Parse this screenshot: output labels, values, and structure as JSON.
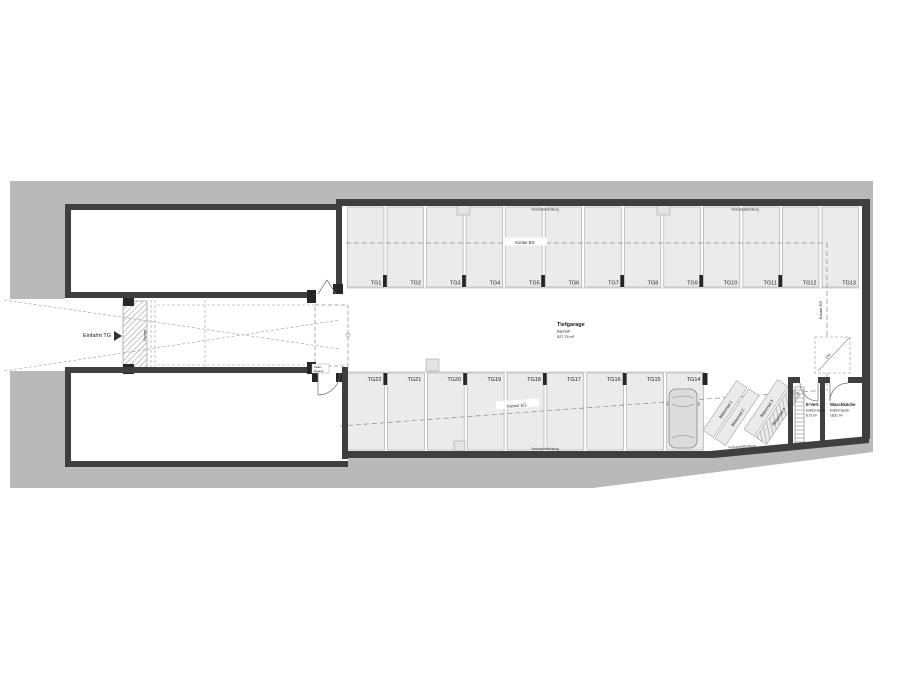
{
  "colors": {
    "site_gray": "#b9b9b9",
    "wall": "#3f3f3f",
    "stall_fill": "#ebebeb",
    "line": "#9a9a9a",
    "text": "#1a1a1a"
  },
  "entrance": {
    "label": "Einfahrt TG",
    "ramp_label": "Rampe"
  },
  "garage": {
    "name": "Tiefgarage",
    "surface": "Asphalt",
    "area": "527,75 m²"
  },
  "annotations": {
    "contour": "Kontur EG",
    "wall_note": "Verbundabdichtung",
    "slope": "2%",
    "door_note_line1": "Keller-",
    "door_note_line2": "abgang"
  },
  "stalls": {
    "top": [
      "TG1",
      "TG2",
      "TG3",
      "TG4",
      "TG5",
      "TG6",
      "TG7",
      "TG8",
      "TG9",
      "TG10",
      "TG11",
      "TG12",
      "TG13"
    ],
    "bottom": [
      "TG22",
      "TG21",
      "TG20",
      "TG19",
      "TG18",
      "TG17",
      "TG16",
      "TG15",
      "TG14"
    ],
    "moto": [
      "Motorrad 1",
      "Motorrad 2",
      "Motorrad 3",
      "Motorrad 4"
    ]
  },
  "rooms": [
    {
      "name": "E-Vert.",
      "finish": "Estrich besch.",
      "area": "8,73 m²"
    },
    {
      "name": "Waschküche",
      "finish": "Estrich besch.",
      "area": "18,81 m²"
    }
  ]
}
